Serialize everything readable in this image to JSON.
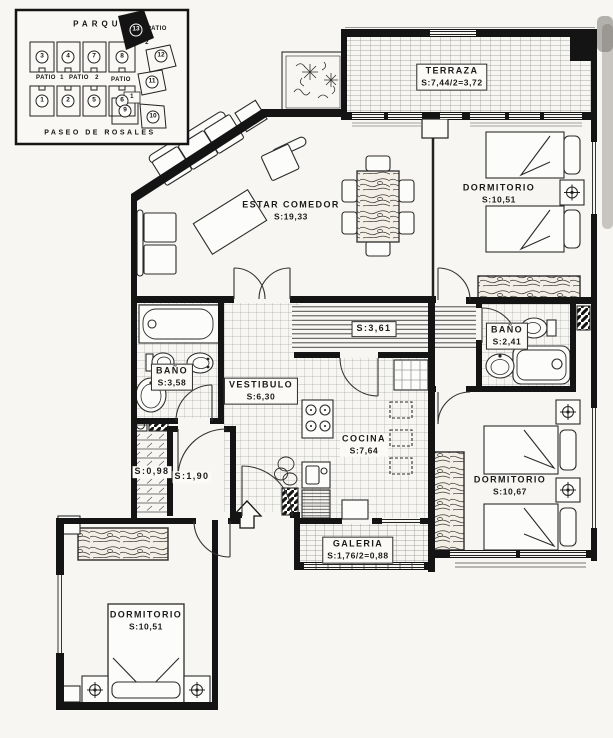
{
  "inset": {
    "park_label": "PARQUE",
    "street_label": "PASEO DE ROSALES",
    "units": [
      "1",
      "2",
      "3",
      "4",
      "5",
      "6",
      "7",
      "8",
      "9",
      "10",
      "11",
      "12",
      "13"
    ],
    "patios": [
      "PATIO",
      "1",
      "PATIO",
      "2",
      "PATIO",
      "PATIO",
      "2",
      "1"
    ]
  },
  "rooms": {
    "terraza": {
      "name": "TERRAZA",
      "area": "S:7,44/2=3,72"
    },
    "dormitorio_sup": {
      "name": "DORMITORIO",
      "area": "S:10,51"
    },
    "estar_comedor": {
      "name": "ESTAR COMEDOR",
      "area": "S:19,33"
    },
    "pasillo": {
      "area": "S:3,61"
    },
    "bano_izquierdo": {
      "name": "BAÑO",
      "area": "S:3,58"
    },
    "vestibulo": {
      "name": "VESTIBULO",
      "area": "S:6,30"
    },
    "bano_derecho": {
      "name": "BAÑO",
      "area": "S:2,41"
    },
    "cocina": {
      "name": "COCINA",
      "area": "S:7,64"
    },
    "armario": {
      "area": "S:0,98"
    },
    "paso": {
      "area": "S:1,90"
    },
    "dormitorio_der": {
      "name": "DORMITORIO",
      "area": "S:10,67"
    },
    "galeria": {
      "name": "GALERIA",
      "area": "S:1,76/2=0,88"
    },
    "dormitorio_inf": {
      "name": "DORMITORIO",
      "area": "S:10,51"
    }
  },
  "colors": {
    "ink": "#141414",
    "paper": "#f7f6f2"
  }
}
